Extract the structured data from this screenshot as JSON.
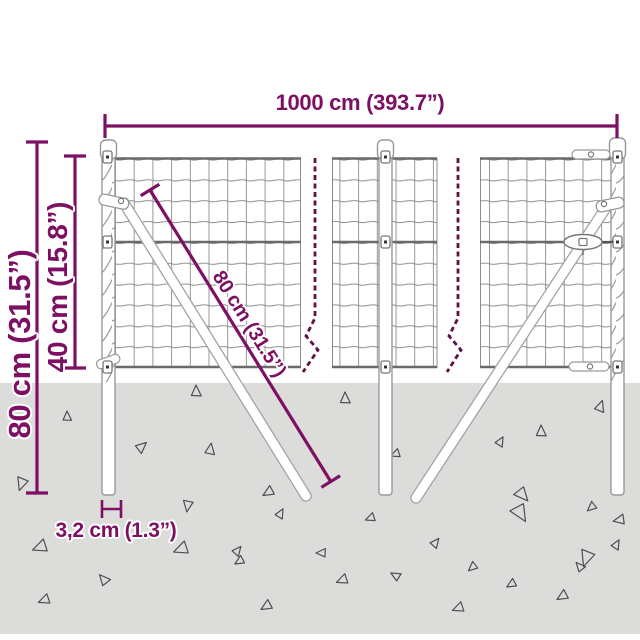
{
  "diagram": {
    "type": "product-dimension-diagram",
    "subject": "wire mesh garden fence with spiral ground-anchor posts and diagonal braces"
  },
  "colors": {
    "accent": "#7D1063",
    "break_line": "#5E1240",
    "ground": "#DCDCDA",
    "wire": "#8C8C8C",
    "thick_wire": "#6A6A6A",
    "outline": "#999999",
    "triangle": "#4F4F4F"
  },
  "dimensions": {
    "total_width": {
      "label": "1000 cm (393.7”)"
    },
    "total_height": {
      "label": "80 cm (31.5”)"
    },
    "mesh_height": {
      "label": "40 cm (15.8”)"
    },
    "brace_length": {
      "label": "80 cm (31.5”)"
    },
    "post_diameter": {
      "label": "3,2 cm (1.3”)"
    }
  },
  "ground": {
    "triangles": [
      [
        67,
        417,
        6,
        0
      ],
      [
        196,
        392,
        7,
        0
      ],
      [
        345,
        399,
        7,
        0
      ],
      [
        600,
        407,
        7,
        20
      ],
      [
        541,
        432,
        7,
        0
      ],
      [
        141,
        447,
        7,
        50
      ],
      [
        210,
        450,
        7,
        10
      ],
      [
        396,
        454,
        6,
        250
      ],
      [
        500,
        442,
        6,
        30
      ],
      [
        22,
        483,
        8,
        200
      ],
      [
        188,
        505,
        7,
        190
      ],
      [
        269,
        492,
        7,
        240
      ],
      [
        522,
        494,
        9,
        140
      ],
      [
        592,
        507,
        6,
        230
      ],
      [
        620,
        520,
        7,
        260
      ],
      [
        280,
        514,
        6,
        30
      ],
      [
        371,
        518,
        6,
        250
      ],
      [
        520,
        512,
        11,
        150
      ],
      [
        41,
        547,
        9,
        250
      ],
      [
        104,
        580,
        7,
        320
      ],
      [
        45,
        600,
        7,
        250
      ],
      [
        182,
        549,
        9,
        250
      ],
      [
        237,
        551,
        6,
        40
      ],
      [
        322,
        553,
        6,
        270
      ],
      [
        343,
        580,
        7,
        250
      ],
      [
        267,
        606,
        7,
        240
      ],
      [
        396,
        576,
        6,
        300
      ],
      [
        435,
        543,
        6,
        40
      ],
      [
        473,
        567,
        6,
        230
      ],
      [
        459,
        608,
        7,
        250
      ],
      [
        587,
        557,
        10,
        200
      ],
      [
        563,
        596,
        7,
        240
      ],
      [
        616,
        545,
        6,
        30
      ],
      [
        512,
        584,
        6,
        240
      ],
      [
        580,
        567,
        6,
        320
      ],
      [
        240,
        561,
        6,
        240
      ]
    ]
  }
}
